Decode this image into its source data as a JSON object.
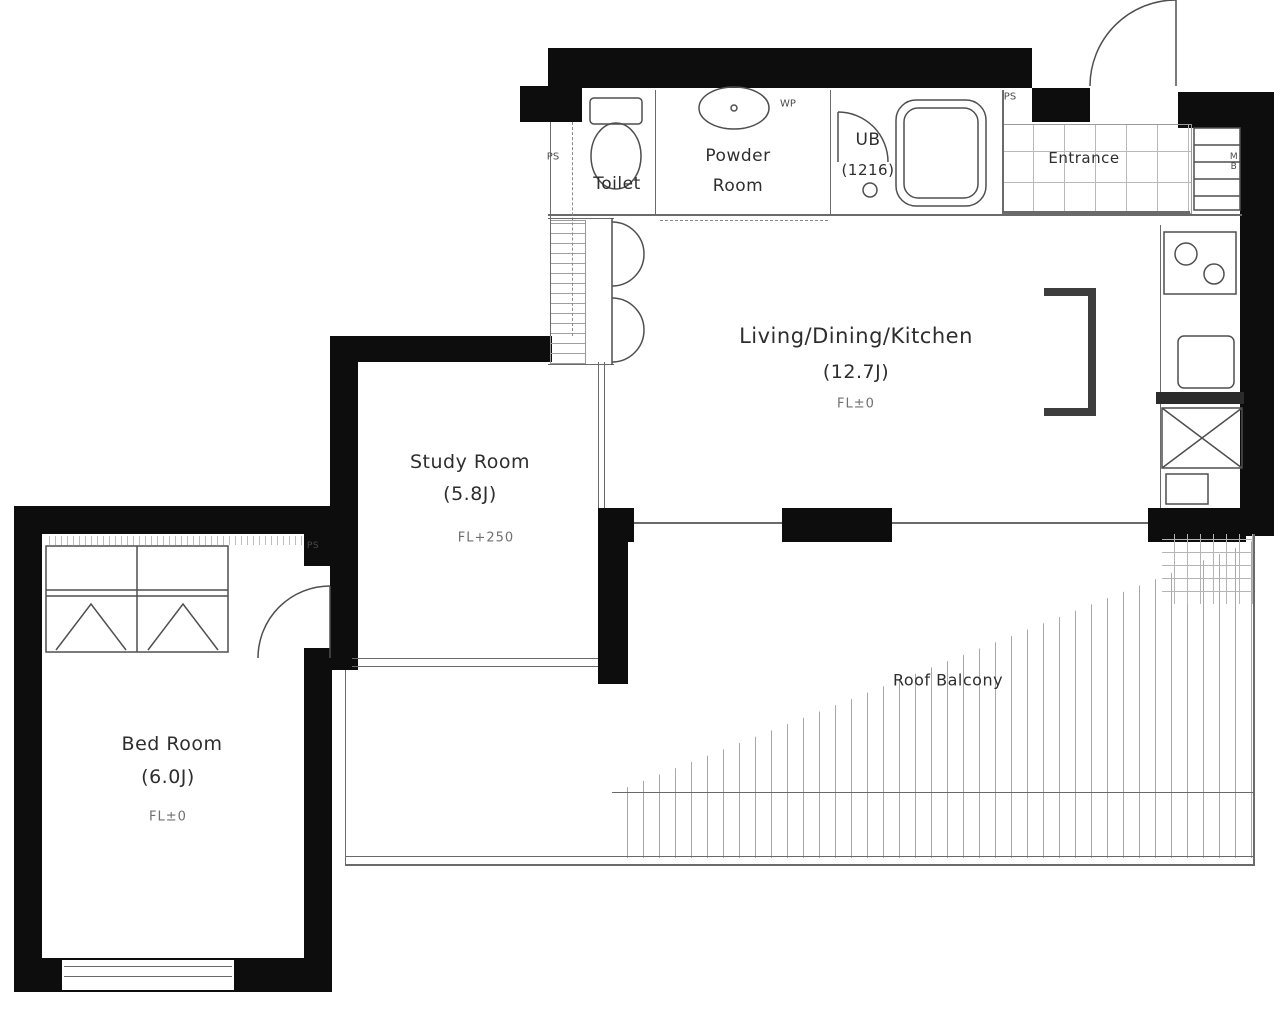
{
  "plan_title": "Apartment floor plan",
  "rooms": {
    "toilet": {
      "name": "Toilet"
    },
    "powder_room": {
      "name_line1": "Powder",
      "name_line2": "Room"
    },
    "unit_bath": {
      "name": "UB",
      "size": "(1216)"
    },
    "entrance": {
      "name": "Entrance"
    },
    "ldk": {
      "name": "Living/Dining/Kitchen",
      "size": "(12.7J)",
      "floor_level": "FL±0"
    },
    "study_room": {
      "name": "Study Room",
      "size": "(5.8J)",
      "floor_level": "FL+250"
    },
    "bed_room": {
      "name": "Bed Room",
      "size": "(6.0J)",
      "floor_level": "FL±0"
    },
    "roof_balcony": {
      "name": "Roof Balcony"
    }
  },
  "shafts": {
    "ps_toilet": "PS",
    "ps_entrance": "PS",
    "ps_bedroom": "PS",
    "wp": "WP",
    "mb": "MB"
  },
  "colors": {
    "wall": "#0d0d0d",
    "line": "#6a6a6a",
    "hatch": "#a8a8a8",
    "text": "#2e2e2e",
    "muted_text": "#707070"
  }
}
